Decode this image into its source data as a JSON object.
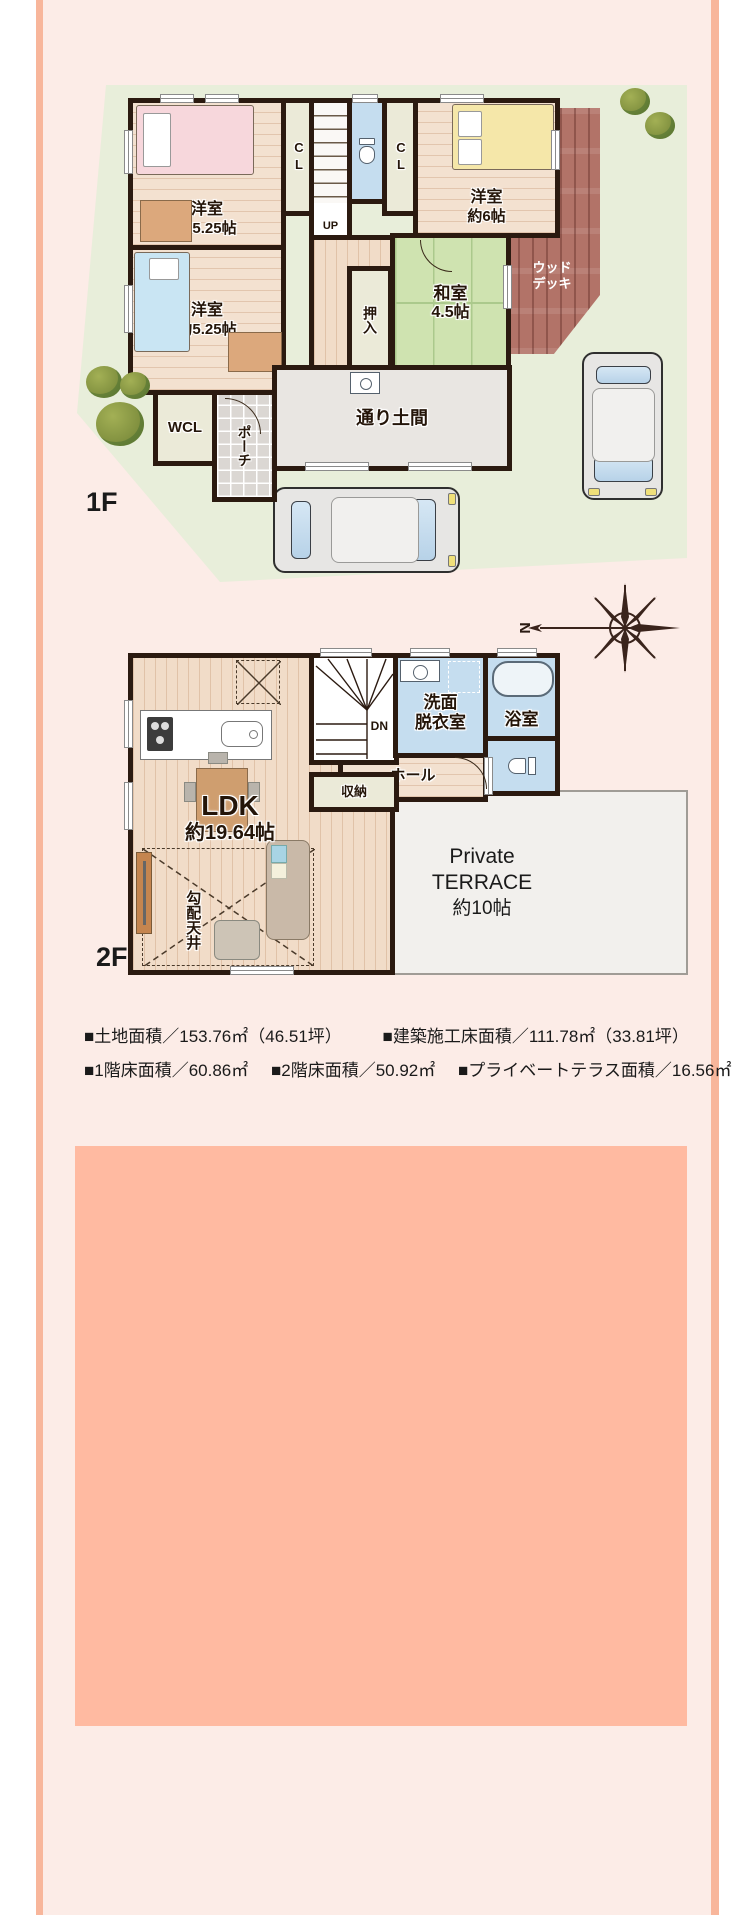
{
  "f1": {
    "floor_label": "1F",
    "rooms": {
      "bedroom_nw": {
        "name": "洋室",
        "size": "約5.25帖"
      },
      "closet_nw": "CL",
      "stairs_up": "UP",
      "closet_ne": "CL",
      "bedroom_ne": {
        "name": "洋室",
        "size": "約6帖"
      },
      "wood_deck": {
        "line1": "ウッド",
        "line2": "デッキ"
      },
      "hall": "ホール",
      "oshiire": "押入",
      "washitsu": {
        "name": "和室",
        "size": "4.5帖"
      },
      "bedroom_sw": {
        "name": "洋室",
        "size": "約5.25帖"
      },
      "wcl": "WCL",
      "porch": "ポーチ",
      "doma": "通り土間"
    }
  },
  "f2": {
    "floor_label": "2F",
    "rooms": {
      "ldk": {
        "name": "LDK",
        "size": "約19.64帖"
      },
      "sloped_ceiling": "勾配天井",
      "stairs_down": "DN",
      "washroom": {
        "line1": "洗面",
        "line2": "脱衣室"
      },
      "bathroom": "浴室",
      "hall": "ホール",
      "storage": "収納",
      "terrace": {
        "line1": "Private",
        "line2": "TERRACE",
        "line3": "約10帖"
      }
    }
  },
  "compass": {
    "north": "N"
  },
  "specs": {
    "line1": [
      "■土地面積／153.76㎡（46.51坪）",
      "■建築施工床面積／111.78㎡（33.81坪）"
    ],
    "line2": [
      "■1階床面積／60.86㎡",
      "■2階床面積／50.92㎡",
      "■プライベートテラス面積／16.56㎡"
    ]
  },
  "colors": {
    "background": "#fcece7",
    "accent_strip": "#f8b69b",
    "bottom_panel": "#ffbaa1",
    "site_green": "#e8eeda",
    "wall": "#2b1a10",
    "water_blue": "#c5ddef",
    "tatami_green": "#cfe3b0",
    "deck_brown": "#b27368"
  }
}
